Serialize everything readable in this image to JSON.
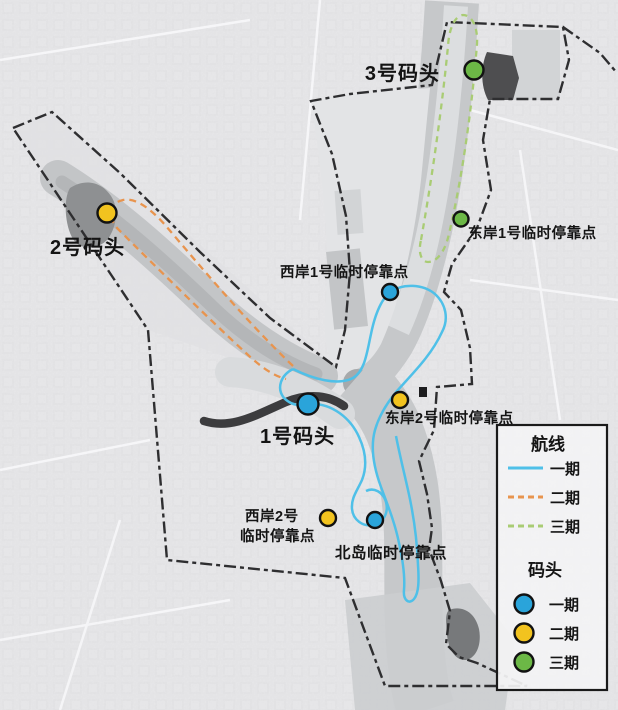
{
  "map_type": "ferry-route-plan-map",
  "docks": [
    {
      "label": "1号码头",
      "color": "#2aa4da"
    },
    {
      "label": "2号码头",
      "color": "#f2c31f"
    },
    {
      "label": "3号码头",
      "color": "#6cb846"
    }
  ],
  "stops": [
    {
      "label": "东岸1号临时停靠点",
      "color": "#6cb846"
    },
    {
      "label": "西岸1号临时停靠点",
      "color": "#2aa4da"
    },
    {
      "label": "东岸2号临时停靠点",
      "color": "#f2c31f"
    },
    {
      "label": "西岸2号临时停靠点",
      "label_line1": "西岸2号",
      "label_line2": "临时停靠点",
      "color": "#f2c31f"
    },
    {
      "label": "北岛临时停靠点",
      "color": "#2aa4da"
    }
  ],
  "legend": {
    "routes_title": "航线",
    "routes": [
      {
        "label": "一期",
        "color": "#4fc0e8",
        "style": "solid"
      },
      {
        "label": "二期",
        "color": "#e8944e",
        "style": "dashed"
      },
      {
        "label": "三期",
        "color": "#a9cc74",
        "style": "dashed"
      }
    ],
    "docks_title": "码头",
    "docks": [
      {
        "label": "一期",
        "color": "#2aa4da"
      },
      {
        "label": "二期",
        "color": "#f2c31f"
      },
      {
        "label": "三期",
        "color": "#6cb846"
      }
    ]
  }
}
